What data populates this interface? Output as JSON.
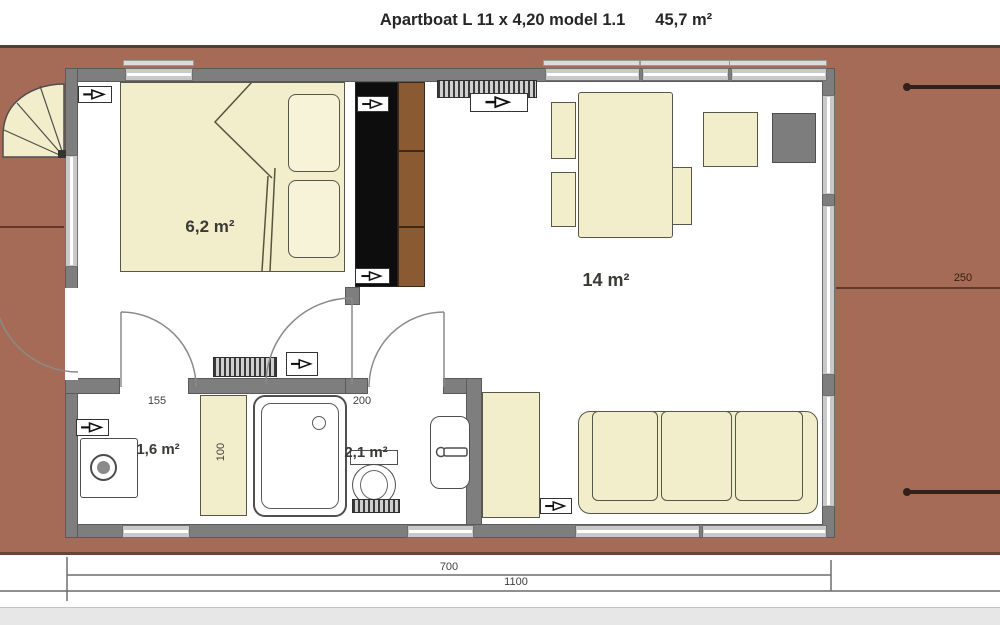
{
  "title": {
    "model_name": "Apartboat L 11 x 4,20 model 1.1",
    "total_area": "45,7 m²"
  },
  "rooms": {
    "bedroom": {
      "label": "6,2 m²"
    },
    "living": {
      "label": "14 m²"
    },
    "utility": {
      "label": "1,6 m²"
    },
    "bathroom": {
      "label": "2,1 m²"
    }
  },
  "dimensions": {
    "interior_length": "700",
    "total_length": "1100",
    "aft_deck": "250",
    "utility_width": "155",
    "closet_depth": "100",
    "bathroom_width": "200"
  },
  "colors": {
    "deck": "#a66b56",
    "wall": "#7e7e7e",
    "floor": "#ffffff",
    "furniture_cream": "#f2eecb",
    "wardrobe_black": "#0d0d0d",
    "shelf_wood": "#8a5a33",
    "appliance_gray": "#7d7d7d",
    "dimension_text": "#3f3f3f"
  },
  "icons": {
    "outlet": "power-outlet-icon",
    "radiator": "radiator-icon",
    "staircase": "spiral-stairs-icon",
    "door": "door-swing-arc",
    "mooring": "mooring-line"
  }
}
